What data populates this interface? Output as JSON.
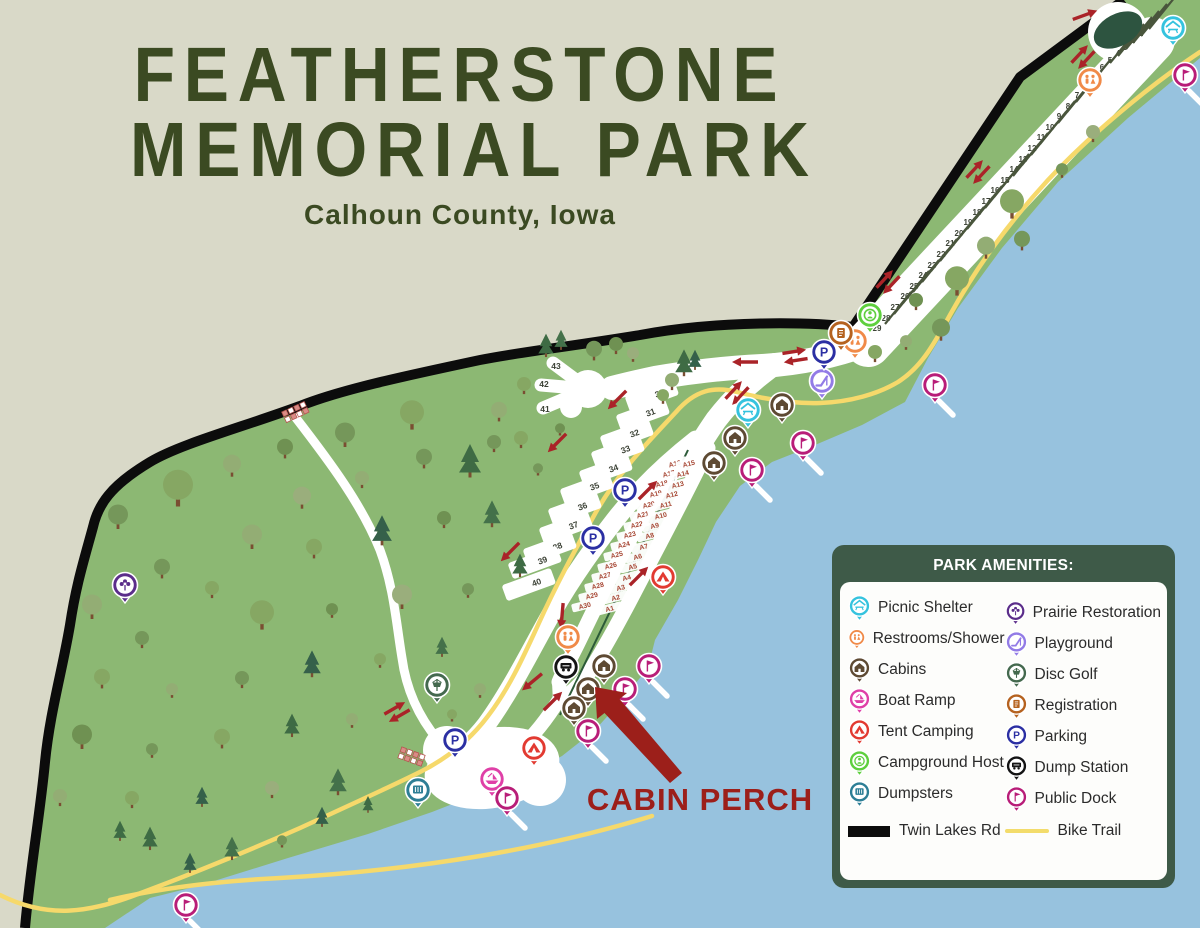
{
  "title": {
    "line1": "FEATHERSTONE",
    "line2": "MEMORIAL PARK",
    "subtitle": "Calhoun County, Iowa"
  },
  "annotation": {
    "label": "CABIN PERCH"
  },
  "legend": {
    "title": "PARK AMENITIES:",
    "left_items": [
      {
        "type": "picnic_shelter",
        "label": "Picnic Shelter"
      },
      {
        "type": "restrooms",
        "label": "Restrooms/Shower"
      },
      {
        "type": "cabins",
        "label": "Cabins"
      },
      {
        "type": "boat_ramp",
        "label": "Boat Ramp"
      },
      {
        "type": "tent_camping",
        "label": "Tent Camping"
      },
      {
        "type": "campground_host",
        "label": "Campground Host"
      },
      {
        "type": "dumpsters",
        "label": "Dumpsters"
      }
    ],
    "right_items": [
      {
        "type": "prairie_restoration",
        "label": "Prairie Restoration"
      },
      {
        "type": "playground",
        "label": "Playground"
      },
      {
        "type": "disc_golf",
        "label": "Disc Golf"
      },
      {
        "type": "registration",
        "label": "Registration"
      },
      {
        "type": "parking",
        "label": "Parking"
      },
      {
        "type": "dump_station",
        "label": "Dump Station"
      },
      {
        "type": "public_dock",
        "label": "Public Dock"
      }
    ],
    "road_label": "Twin Lakes Rd",
    "trail_label": "Bike Trail"
  },
  "colors": {
    "background": "#d9d9c8",
    "park": "#8cb873",
    "water": "#97c2de",
    "road": "#0c0c0c",
    "trail": "#f6d96b",
    "road_white": "#ffffff",
    "arrow": "#aa2328",
    "site_text": "#3c4236",
    "a_site_text": "#a64532",
    "pad_line": "#49553c",
    "center_line": "#2c5a38",
    "title": "#3b4a22",
    "legend_bg": "#3e5a48",
    "annotation": "#9c1f1a",
    "oval": "#2d5440",
    "trunk": "#7a4e32",
    "tree_greens": [
      "#86a763",
      "#75975a",
      "#93ad74",
      "#6f9152",
      "#9aae7c"
    ],
    "pine_greens": [
      "#3e6b44",
      "#35604a",
      "#44714a"
    ],
    "pins": {
      "picnic_shelter": "#35c3de",
      "restrooms": "#f08a48",
      "cabins": "#5e4a33",
      "boat_ramp": "#df3fa7",
      "tent_camping": "#e23a31",
      "campground_host": "#5ecf3e",
      "dumpsters": "#2d7e95",
      "prairie_restoration": "#5b2d8a",
      "playground": "#927be6",
      "disc_golf": "#44694e",
      "registration": "#b5621f",
      "parking": "#2b2fa3",
      "dump_station": "#141414",
      "public_dock": "#b81d78"
    }
  },
  "map": {
    "strip_sites": [
      [
        "1",
        1141,
        33
      ],
      [
        "2",
        1133,
        40
      ],
      [
        "3",
        1125,
        47
      ],
      [
        "4",
        1118,
        53
      ],
      [
        "5",
        1110,
        60
      ],
      [
        "6",
        1102,
        67
      ],
      [
        "7",
        1077,
        95
      ],
      [
        "8",
        1068,
        106
      ],
      [
        "9",
        1059,
        116
      ],
      [
        "10",
        1050,
        127
      ],
      [
        "11",
        1041,
        137
      ],
      [
        "12",
        1032,
        148
      ],
      [
        "13",
        1023,
        159
      ],
      [
        "14",
        1014,
        169
      ],
      [
        "15",
        1005,
        180
      ],
      [
        "16",
        995,
        190
      ],
      [
        "17",
        986,
        201
      ],
      [
        "18",
        977,
        212
      ],
      [
        "19",
        968,
        222
      ],
      [
        "20",
        959,
        233
      ],
      [
        "21",
        950,
        243
      ],
      [
        "22",
        941,
        254
      ],
      [
        "23",
        932,
        265
      ],
      [
        "24",
        923,
        275
      ],
      [
        "25",
        914,
        286
      ],
      [
        "26",
        905,
        296
      ],
      [
        "27",
        895,
        307
      ],
      [
        "28",
        886,
        318
      ],
      [
        "29",
        877,
        328
      ]
    ],
    "loop_sites": [
      [
        "30",
        652,
        396
      ],
      [
        "31",
        643,
        415
      ],
      [
        "32",
        627,
        436
      ],
      [
        "33",
        618,
        452
      ],
      [
        "34",
        606,
        471
      ],
      [
        "35",
        587,
        489
      ],
      [
        "36",
        575,
        509
      ],
      [
        "37",
        566,
        528
      ],
      [
        "38",
        550,
        549
      ],
      [
        "39",
        535,
        563
      ],
      [
        "40",
        529,
        585
      ]
    ],
    "roundabout_sites": [
      [
        "41",
        545,
        409
      ],
      [
        "42",
        544,
        384
      ],
      [
        "43",
        556,
        366
      ]
    ],
    "a_sites_left": [
      [
        "A16",
        675,
        465
      ],
      [
        "A17",
        669,
        475
      ],
      [
        "A18",
        662,
        485
      ],
      [
        "A19",
        656,
        495
      ],
      [
        "A20",
        649,
        506
      ],
      [
        "A21",
        643,
        516
      ],
      [
        "A22",
        637,
        526
      ],
      [
        "A23",
        630,
        536
      ],
      [
        "A24",
        624,
        546
      ],
      [
        "A25",
        617,
        556
      ],
      [
        "A26",
        611,
        567
      ],
      [
        "A27",
        605,
        577
      ],
      [
        "A28",
        598,
        587
      ],
      [
        "A29",
        592,
        597
      ],
      [
        "A30",
        585,
        607
      ]
    ],
    "a_sites_right": [
      [
        "A15",
        689,
        465
      ],
      [
        "A14",
        683,
        475
      ],
      [
        "A13",
        678,
        486
      ],
      [
        "A12",
        672,
        496
      ],
      [
        "A11",
        666,
        506
      ],
      [
        "A10",
        661,
        517
      ],
      [
        "A9",
        655,
        527
      ],
      [
        "A8",
        650,
        537
      ],
      [
        "A7",
        644,
        548
      ],
      [
        "A6",
        638,
        558
      ],
      [
        "A5",
        633,
        568
      ],
      [
        "A4",
        627,
        579
      ],
      [
        "A3",
        621,
        589
      ],
      [
        "A2",
        616,
        599
      ],
      [
        "A1",
        610,
        610
      ]
    ],
    "pins": [
      [
        "picnic_shelter",
        1173,
        28
      ],
      [
        "picnic_shelter",
        748,
        410
      ],
      [
        "restrooms",
        1090,
        80
      ],
      [
        "restrooms",
        855,
        341
      ],
      [
        "restrooms",
        568,
        637
      ],
      [
        "cabins",
        782,
        405
      ],
      [
        "cabins",
        735,
        438
      ],
      [
        "cabins",
        714,
        463
      ],
      [
        "cabins",
        604,
        666
      ],
      [
        "cabins",
        588,
        689
      ],
      [
        "cabins",
        574,
        708
      ],
      [
        "boat_ramp",
        492,
        779
      ],
      [
        "tent_camping",
        663,
        577
      ],
      [
        "tent_camping",
        534,
        748
      ],
      [
        "campground_host",
        870,
        315
      ],
      [
        "dumpsters",
        418,
        790
      ],
      [
        "prairie_restoration",
        125,
        585
      ],
      [
        "playground",
        822,
        381
      ],
      [
        "disc_golf",
        437,
        685
      ],
      [
        "registration",
        841,
        333
      ],
      [
        "parking",
        824,
        352
      ],
      [
        "parking",
        625,
        490
      ],
      [
        "parking",
        593,
        538
      ],
      [
        "parking",
        455,
        740
      ],
      [
        "dump_station",
        566,
        667
      ],
      [
        "public_dock",
        1185,
        75
      ],
      [
        "public_dock",
        935,
        385
      ],
      [
        "public_dock",
        803,
        443
      ],
      [
        "public_dock",
        752,
        470
      ],
      [
        "public_dock",
        649,
        666
      ],
      [
        "public_dock",
        625,
        689
      ],
      [
        "public_dock",
        588,
        731
      ],
      [
        "public_dock",
        507,
        798
      ],
      [
        "public_dock",
        186,
        905
      ]
    ],
    "arrows_single": [
      [
        745,
        362,
        180
      ],
      [
        617,
        400,
        135
      ],
      [
        557,
        443,
        135
      ],
      [
        510,
        552,
        135
      ],
      [
        648,
        490,
        -45
      ],
      [
        639,
        576,
        -45
      ],
      [
        562,
        616,
        95
      ],
      [
        532,
        682,
        140
      ],
      [
        553,
        701,
        -45
      ],
      [
        1085,
        15,
        -20
      ]
    ],
    "arrows_double": [
      [
        1083,
        57,
        -47
      ],
      [
        978,
        172,
        -47
      ],
      [
        888,
        282,
        -47
      ],
      [
        795,
        356,
        -9
      ],
      [
        737,
        393,
        -47
      ],
      [
        397,
        712,
        -30
      ]
    ],
    "crosswalks": [
      [
        296,
        412,
        -25
      ],
      [
        412,
        757,
        20
      ]
    ],
    "trees": [
      [
        1012,
        215,
        "d",
        12,
        0
      ],
      [
        1022,
        248,
        "d",
        8,
        1
      ],
      [
        986,
        256,
        "d",
        9,
        2
      ],
      [
        957,
        292,
        "d",
        12,
        0
      ],
      [
        916,
        308,
        "d",
        7,
        3
      ],
      [
        941,
        338,
        "d",
        9,
        1
      ],
      [
        906,
        348,
        "d",
        6,
        2
      ],
      [
        875,
        360,
        "d",
        7,
        0
      ],
      [
        1093,
        140,
        "d",
        7,
        4
      ],
      [
        1062,
        176,
        "d",
        6,
        1
      ],
      [
        672,
        388,
        "d",
        7,
        2
      ],
      [
        663,
        402,
        "d",
        6,
        0
      ],
      [
        684,
        375,
        "p",
        8,
        0
      ],
      [
        695,
        369,
        "p",
        6,
        1
      ],
      [
        594,
        358,
        "d",
        8,
        1
      ],
      [
        616,
        352,
        "d",
        7,
        3
      ],
      [
        524,
        392,
        "d",
        7,
        0
      ],
      [
        499,
        419,
        "d",
        8,
        2
      ],
      [
        494,
        450,
        "d",
        7,
        1
      ],
      [
        546,
        356,
        "p",
        7,
        0
      ],
      [
        561,
        349,
        "p",
        6,
        2
      ],
      [
        633,
        360,
        "d",
        6,
        4
      ],
      [
        178,
        502,
        "d",
        15,
        0
      ],
      [
        118,
        526,
        "d",
        10,
        1
      ],
      [
        232,
        474,
        "d",
        9,
        2
      ],
      [
        285,
        456,
        "d",
        8,
        3
      ],
      [
        345,
        444,
        "d",
        10,
        1
      ],
      [
        412,
        426,
        "d",
        12,
        0
      ],
      [
        302,
        506,
        "d",
        9,
        4
      ],
      [
        362,
        486,
        "d",
        7,
        2
      ],
      [
        424,
        466,
        "d",
        8,
        1
      ],
      [
        470,
        476,
        "p",
        10,
        0
      ],
      [
        521,
        446,
        "d",
        7,
        0
      ],
      [
        252,
        546,
        "d",
        10,
        2
      ],
      [
        314,
        556,
        "d",
        8,
        0
      ],
      [
        382,
        544,
        "p",
        9,
        1
      ],
      [
        444,
        526,
        "d",
        7,
        3
      ],
      [
        492,
        526,
        "p",
        8,
        2
      ],
      [
        162,
        576,
        "d",
        8,
        1
      ],
      [
        212,
        596,
        "d",
        7,
        0
      ],
      [
        92,
        616,
        "d",
        10,
        2
      ],
      [
        142,
        646,
        "d",
        7,
        1
      ],
      [
        262,
        626,
        "d",
        12,
        0
      ],
      [
        332,
        616,
        "d",
        6,
        3
      ],
      [
        402,
        606,
        "d",
        10,
        4
      ],
      [
        468,
        596,
        "d",
        6,
        1
      ],
      [
        520,
        576,
        "p",
        7,
        0
      ],
      [
        102,
        686,
        "d",
        8,
        0
      ],
      [
        172,
        696,
        "d",
        6,
        2
      ],
      [
        242,
        686,
        "d",
        7,
        1
      ],
      [
        312,
        676,
        "p",
        8,
        1
      ],
      [
        380,
        666,
        "d",
        6,
        0
      ],
      [
        442,
        656,
        "p",
        6,
        2
      ],
      [
        82,
        746,
        "d",
        10,
        3
      ],
      [
        152,
        756,
        "d",
        6,
        1
      ],
      [
        222,
        746,
        "d",
        8,
        0
      ],
      [
        292,
        736,
        "p",
        7,
        0
      ],
      [
        352,
        726,
        "d",
        6,
        2
      ],
      [
        132,
        806,
        "d",
        7,
        0
      ],
      [
        202,
        806,
        "p",
        6,
        1
      ],
      [
        272,
        796,
        "d",
        7,
        4
      ],
      [
        338,
        794,
        "p",
        8,
        2
      ],
      [
        150,
        849,
        "p",
        7,
        0
      ],
      [
        190,
        872,
        "p",
        6,
        1
      ],
      [
        232,
        859,
        "p",
        7,
        2
      ],
      [
        120,
        840,
        "p",
        6,
        0
      ],
      [
        282,
        846,
        "d",
        5,
        1
      ],
      [
        322,
        826,
        "p",
        6,
        1
      ],
      [
        368,
        812,
        "p",
        5,
        0
      ],
      [
        480,
        696,
        "d",
        6,
        2
      ],
      [
        452,
        720,
        "d",
        5,
        0
      ],
      [
        538,
        474,
        "d",
        5,
        1
      ],
      [
        560,
        434,
        "d",
        5,
        3
      ],
      [
        60,
        804,
        "d",
        7,
        2
      ]
    ]
  }
}
